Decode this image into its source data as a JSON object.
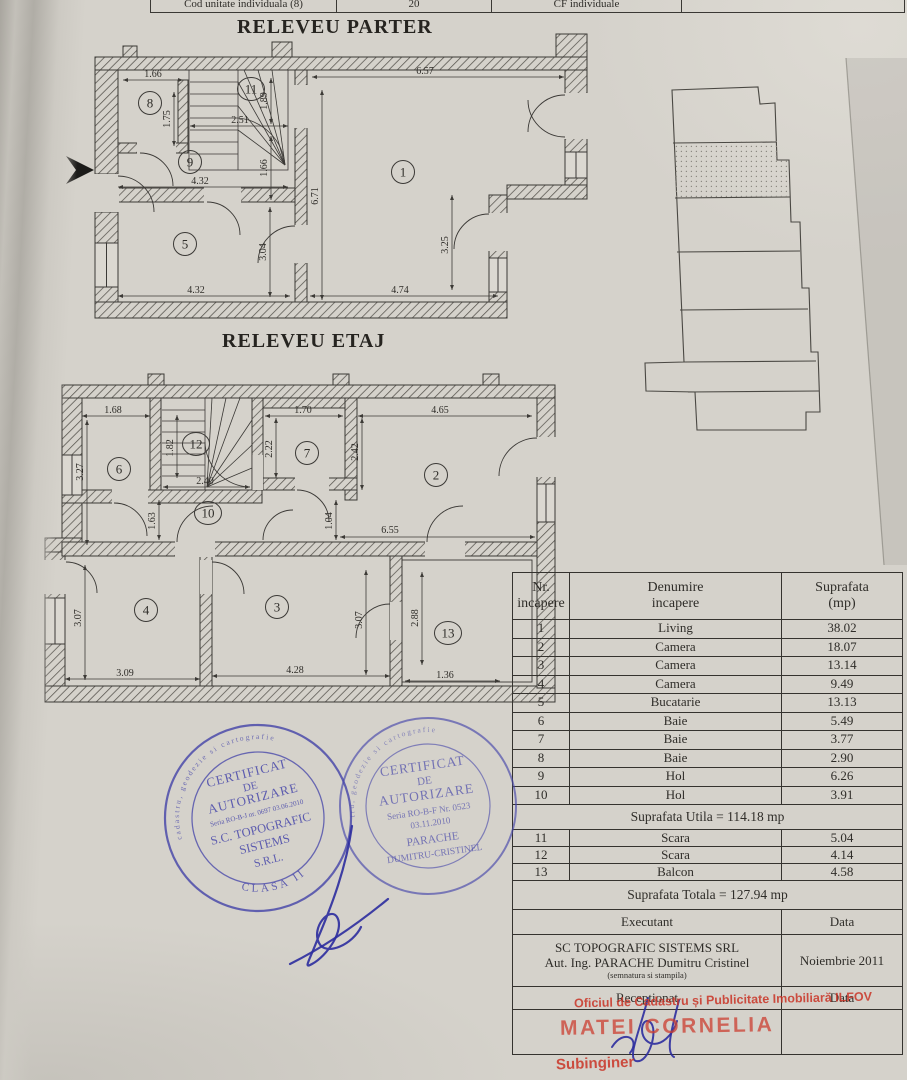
{
  "page": {
    "title_parter": "RELEVEU PARTER",
    "title_etaj": "RELEVEU ETAJ"
  },
  "top_row": {
    "c1": "Cod unitate individuala (8)",
    "c2": "20",
    "c3": "CF individuale"
  },
  "parter": {
    "rooms": {
      "r8": "8",
      "r11": "11",
      "r9": "9",
      "r1": "1",
      "r5": "5"
    },
    "dims": {
      "d166a": "1.66",
      "d175": "1.75",
      "d251": "2.51",
      "d189": "1.89",
      "d657": "6.57",
      "d166b": "1.66",
      "d671": "6.71",
      "d432a": "4.32",
      "d304": "3.04",
      "d325": "3.25",
      "d432b": "4.32",
      "d474": "4.74"
    }
  },
  "etaj": {
    "rooms": {
      "r6": "6",
      "r12": "12",
      "r7": "7",
      "r2": "2",
      "r10": "10",
      "r4": "4",
      "r3": "3",
      "r13": "13"
    },
    "dims": {
      "d168": "1.68",
      "d182": "1.82",
      "d170": "1.70",
      "d465": "4.65",
      "d327": "3.27",
      "d222": "2.22",
      "d242": "2.42",
      "d240": "2.40",
      "d163": "1.63",
      "d104": "1.04",
      "d655": "6.55",
      "d307a": "3.07",
      "d307b": "3.07",
      "d288": "2.88",
      "d309": "3.09",
      "d428": "4.28",
      "d136": "1.36"
    }
  },
  "table": {
    "header": {
      "c1a": "Nr.",
      "c1b": "incapere",
      "c2a": "Denumire",
      "c2b": "incapere",
      "c3a": "Suprafata",
      "c3b": "(mp)"
    },
    "rooms": [
      {
        "nr": "1",
        "name": "Living",
        "area": "38.02"
      },
      {
        "nr": "2",
        "name": "Camera",
        "area": "18.07"
      },
      {
        "nr": "3",
        "name": "Camera",
        "area": "13.14"
      },
      {
        "nr": "4",
        "name": "Camera",
        "area": "9.49"
      },
      {
        "nr": "5",
        "name": "Bucatarie",
        "area": "13.13"
      },
      {
        "nr": "6",
        "name": "Baie",
        "area": "5.49"
      },
      {
        "nr": "7",
        "name": "Baie",
        "area": "3.77"
      },
      {
        "nr": "8",
        "name": "Baie",
        "area": "2.90"
      },
      {
        "nr": "9",
        "name": "Hol",
        "area": "6.26"
      },
      {
        "nr": "10",
        "name": "Hol",
        "area": "3.91"
      }
    ],
    "utila": "Suprafata Utila = 114.18 mp",
    "annex": [
      {
        "nr": "11",
        "name": "Scara",
        "area": "5.04"
      },
      {
        "nr": "12",
        "name": "Scara",
        "area": "4.14"
      },
      {
        "nr": "13",
        "name": "Balcon",
        "area": "4.58"
      }
    ],
    "totala": "Suprafata Totala = 127.94 mp",
    "executant_label": "Executant",
    "data_label": "Data",
    "exec_line1": "SC TOPOGRAFIC SISTEMS SRL",
    "exec_line2": "Aut. Ing. PARACHE Dumitru Cristinel",
    "exec_note": "(semnatura si stampila)",
    "exec_date": "Noiembrie 2011",
    "receptionat_label": "Receptionat",
    "data_label2": "Data"
  },
  "stamps": {
    "left": {
      "l1": "CERTIFICAT",
      "l2": "DE",
      "l3": "AUTORIZARE",
      "l4": "Seria RO-B-J nr. 0697 03.06.2010",
      "l5": "S.C. TOPOGRAFIC",
      "l6": "SISTEMS",
      "l7": "S.R.L.",
      "arc": "CLASA II",
      "rim": "Persoana juridica autorizata de cadastru, geodezie si cartografie"
    },
    "right": {
      "l1": "CERTIFICAT",
      "l2": "DE",
      "l3": "AUTORIZARE",
      "l4": "Seria RO-B-F Nr. 0523",
      "l5": "03.11.2010",
      "l6": "PARACHE",
      "l7": "DUMITRU-CRISTINEL",
      "rim": "de cadastru, geodezie si cartografie"
    }
  },
  "red_stamp": {
    "line1": "Oficiul de Cadastru și Publicitate Imobiliară ILFOV",
    "line2": "MATEI CORNELIA",
    "line3": "Subinginer"
  }
}
